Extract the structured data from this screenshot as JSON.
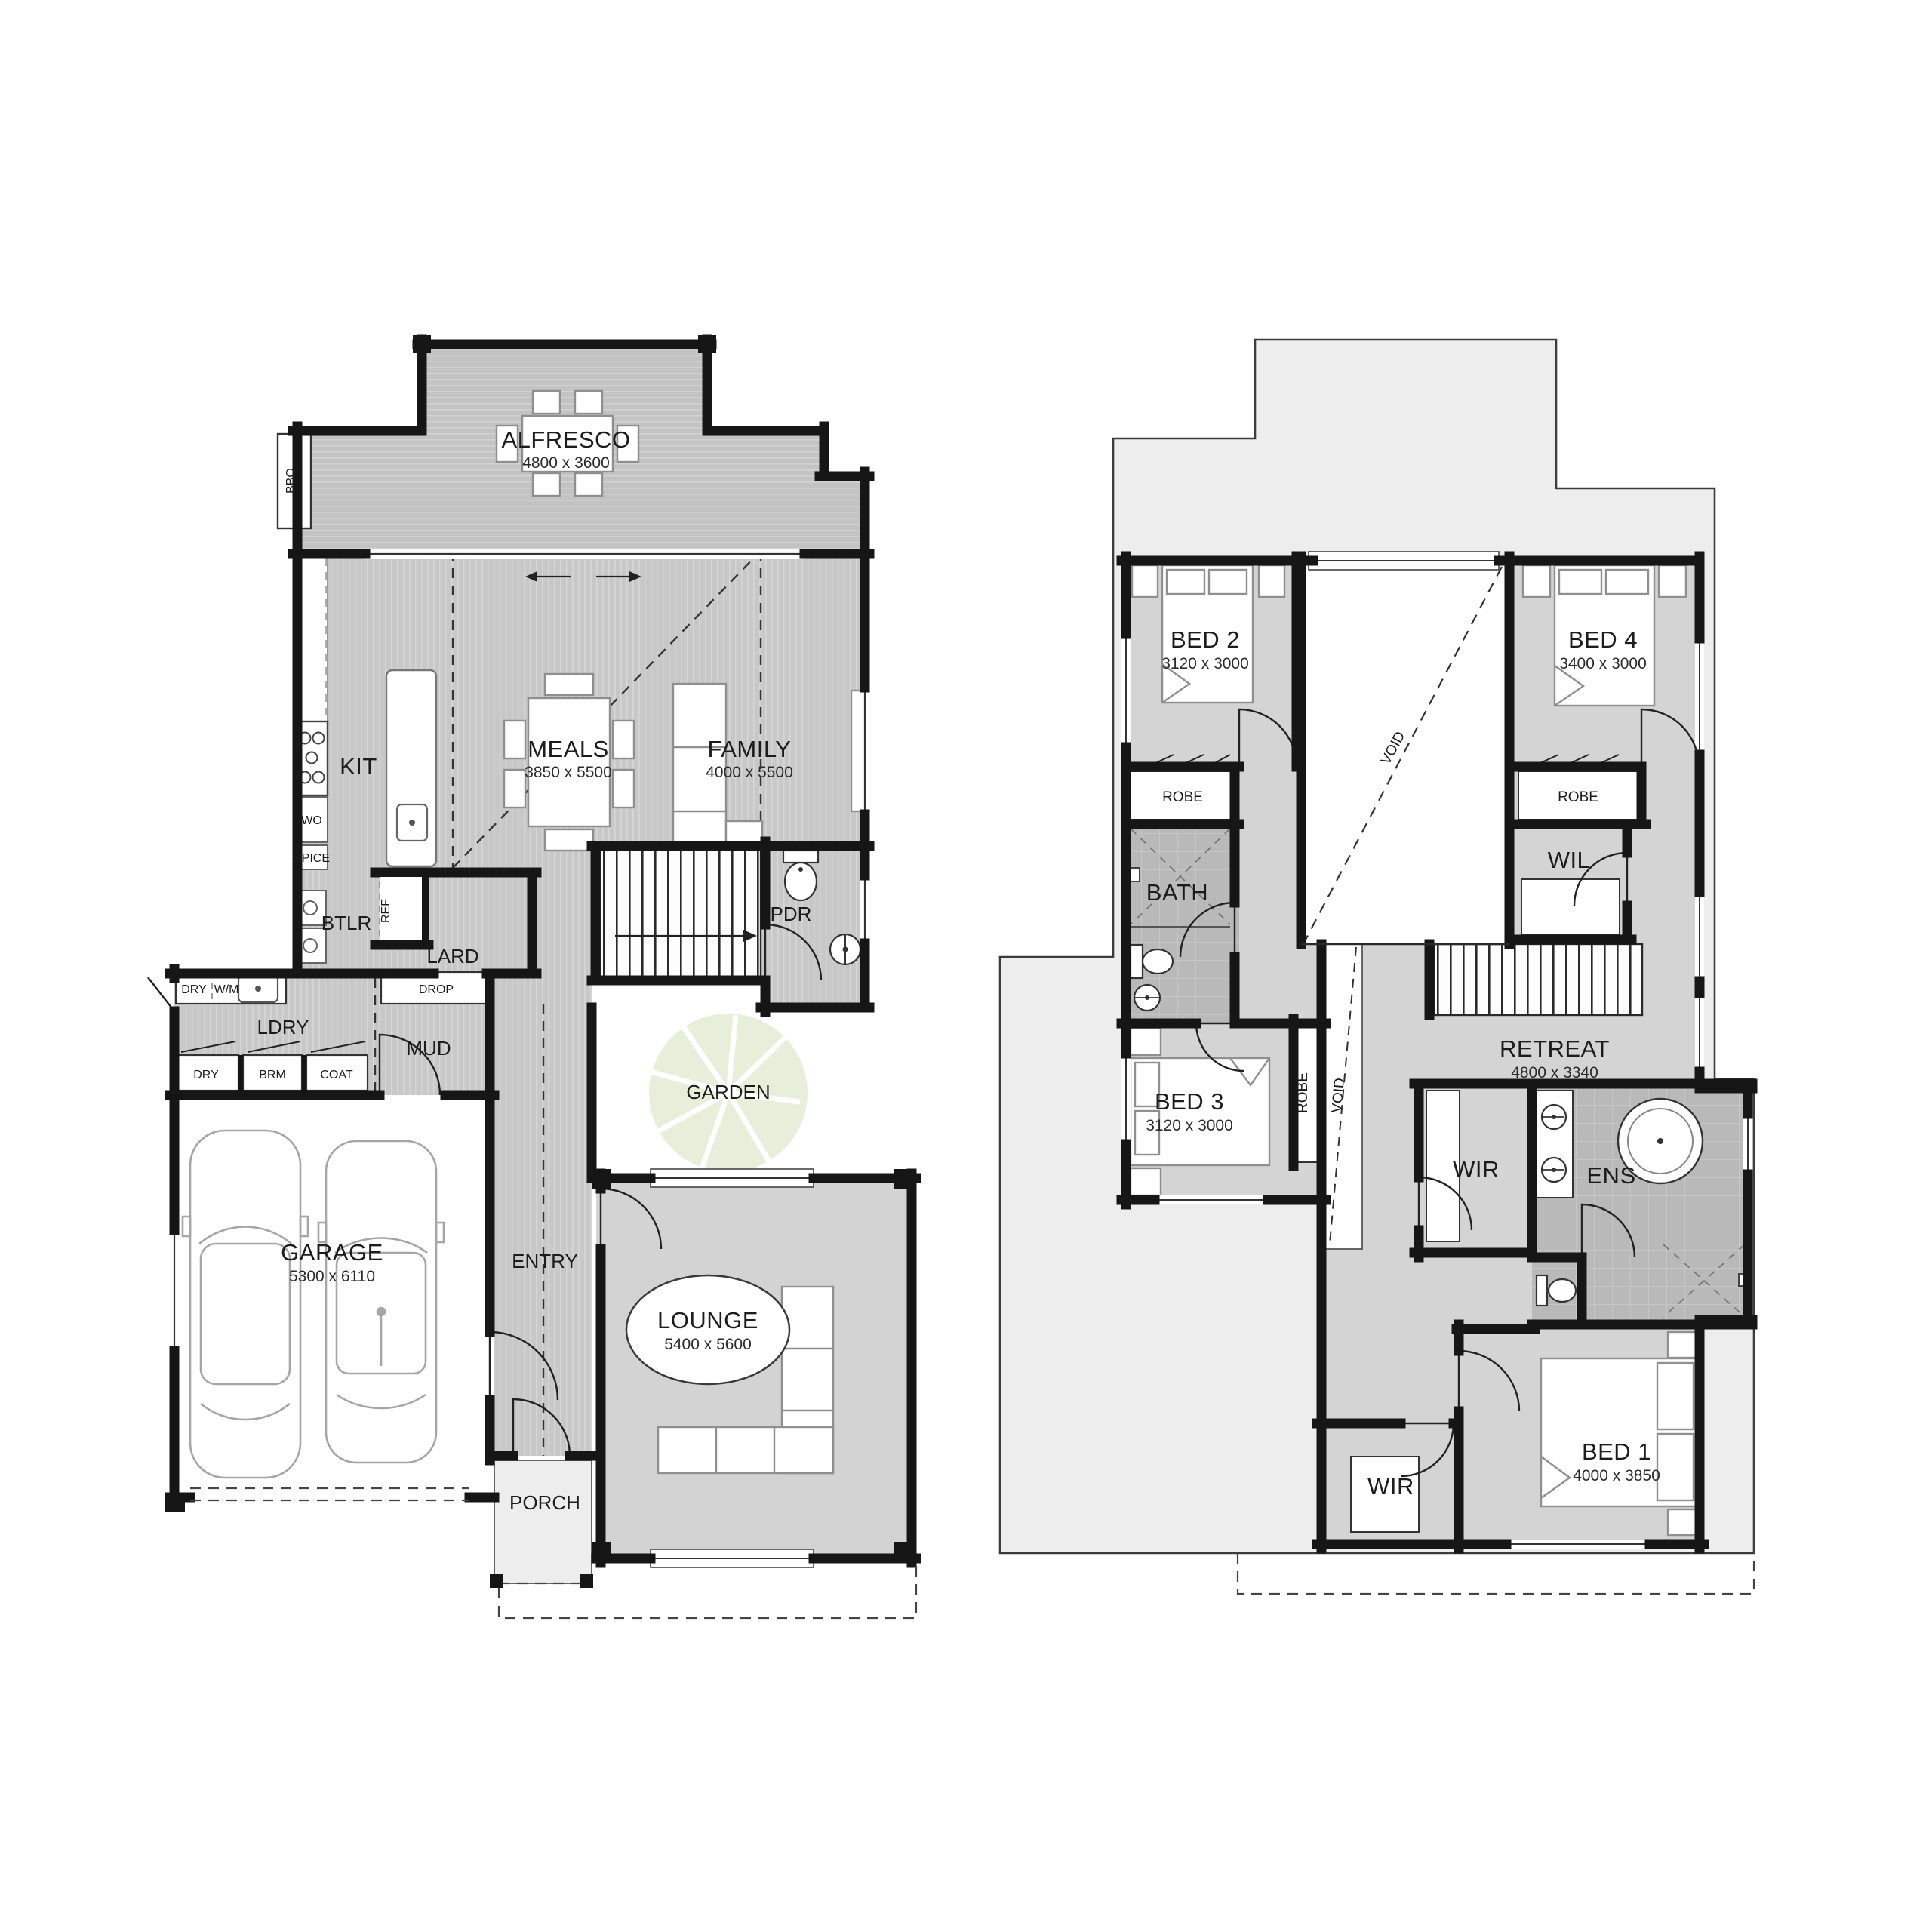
{
  "title": "Two storey home floor plans (ground floor and first floor)",
  "colors": {
    "wall": "#161616",
    "floor_stripe": "#c8c8c8",
    "deck_stripe": "#c3c3c3",
    "flat_room": "#d3d3d3",
    "tile": "#b9b9b9",
    "roof": "#ededed",
    "garden": "#e7efdb",
    "white": "#ffffff"
  },
  "ground_floor": {
    "rooms": {
      "alfresco": {
        "label": "ALFRESCO",
        "dims": "4800 x 3600"
      },
      "kit": {
        "label": "KIT"
      },
      "meals": {
        "label": "MEALS",
        "dims": "3850 x 5500"
      },
      "family": {
        "label": "FAMILY",
        "dims": "4000 x 5500"
      },
      "btlr": {
        "label": "BTLR"
      },
      "lard": {
        "label": "LARD"
      },
      "pdr": {
        "label": "PDR"
      },
      "ldry": {
        "label": "LDRY"
      },
      "mud": {
        "label": "MUD"
      },
      "garage": {
        "label": "GARAGE",
        "dims": "5300 x 6110"
      },
      "entry": {
        "label": "ENTRY"
      },
      "porch": {
        "label": "PORCH"
      },
      "garden": {
        "label": "GARDEN"
      },
      "lounge": {
        "label": "LOUNGE",
        "dims": "5400 x 5600"
      }
    },
    "fixtures": {
      "bbq": "BBQ",
      "wo": "WO",
      "spice": "SPICE",
      "ref": "REF",
      "drop": "DROP",
      "dry_bench": "DRY",
      "washing_machine": "W/M",
      "dry_cupboard": "DRY",
      "broom": "BRM",
      "coat": "COAT"
    }
  },
  "upper_floor": {
    "rooms": {
      "bed1": {
        "label": "BED 1",
        "dims": "4000 x 3850"
      },
      "bed2": {
        "label": "BED 2",
        "dims": "3120 x 3000"
      },
      "bed3": {
        "label": "BED 3",
        "dims": "3120 x 3000"
      },
      "bed4": {
        "label": "BED 4",
        "dims": "3400 x 3000"
      },
      "bath": {
        "label": "BATH"
      },
      "ens": {
        "label": "ENS"
      },
      "wil": {
        "label": "WIL"
      },
      "wir_master": {
        "label": "WIR"
      },
      "wir_lower": {
        "label": "WIR"
      },
      "retreat": {
        "label": "RETREAT",
        "dims": "4800 x 3340"
      },
      "void_main": {
        "label": "VOID"
      },
      "void_strip": {
        "label": "VOID"
      }
    },
    "fixtures": {
      "robe_bed2": "ROBE",
      "robe_bed3": "ROBE",
      "robe_bed4": "ROBE"
    }
  }
}
